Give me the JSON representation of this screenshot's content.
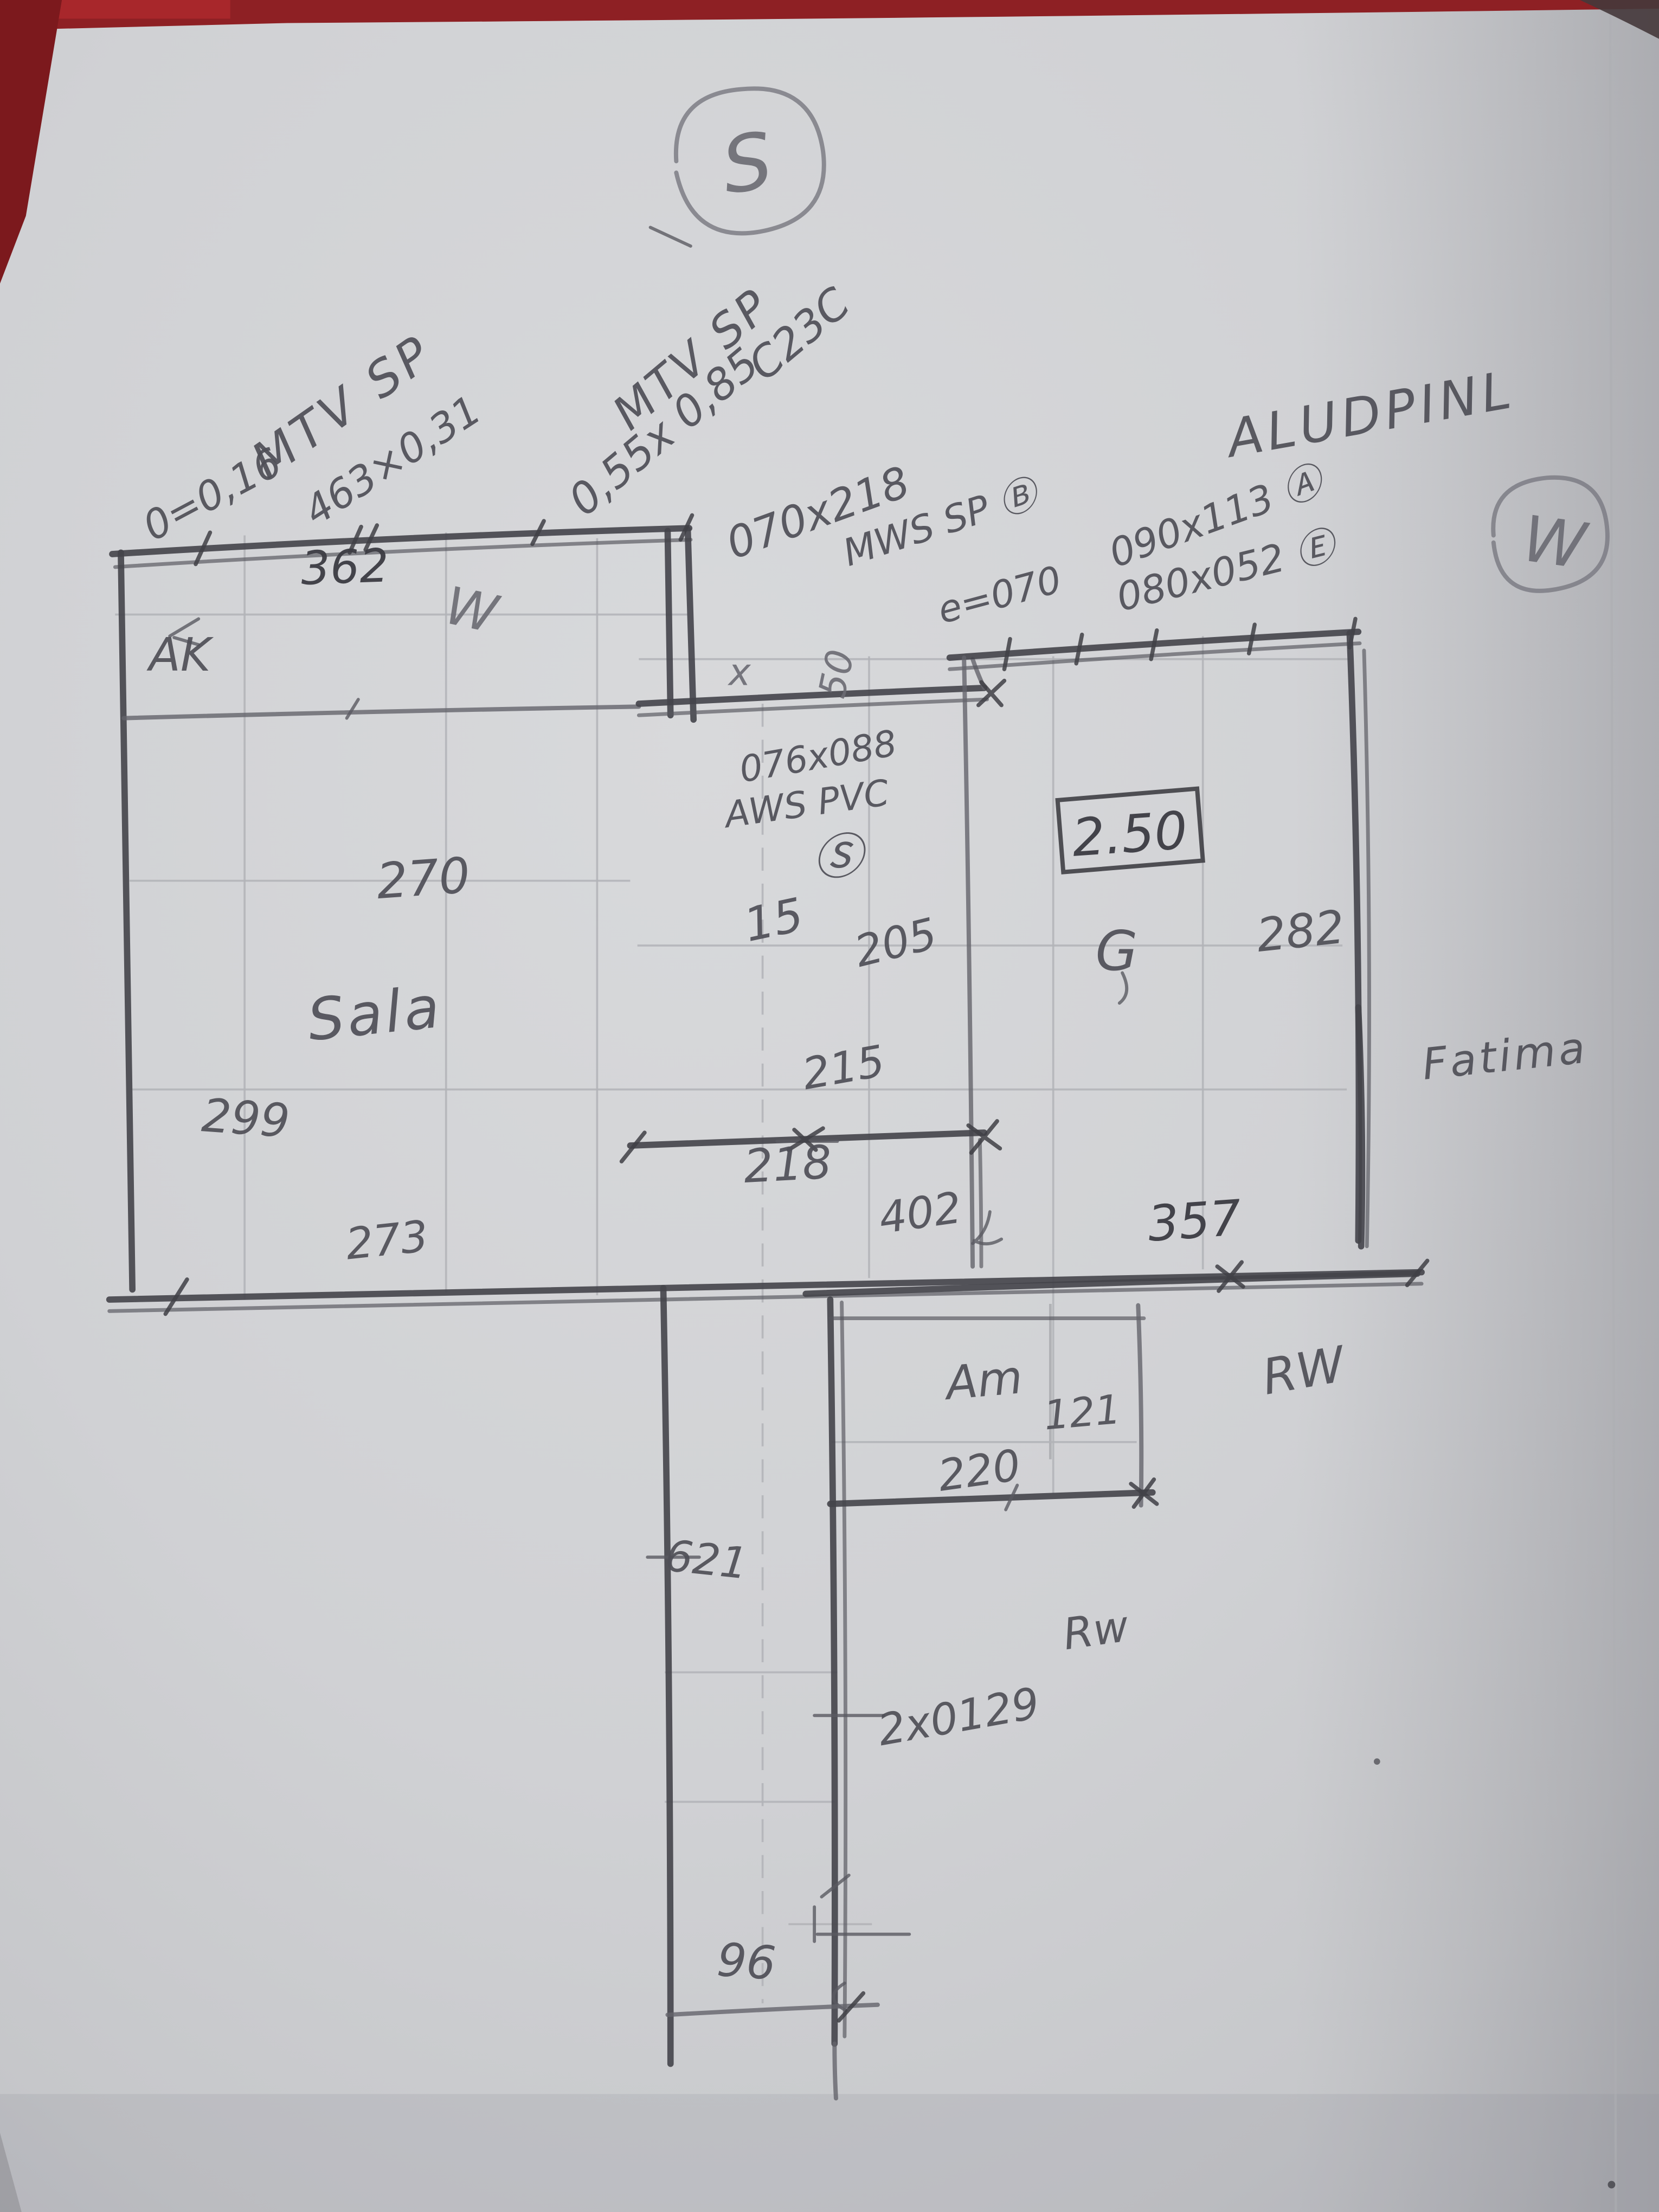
{
  "compass": {
    "south": "S",
    "west": "W"
  },
  "notes": {
    "left_window": {
      "l1": "MTV SP",
      "l2": "0=0,16",
      "l3": "463×0,31"
    },
    "mid_window": {
      "l1": "MTV SP",
      "l2": "0,55x 0,85",
      "l3": "C23C"
    },
    "door": {
      "l1": "070x218",
      "l2": "MWS SP Ⓑ"
    },
    "wall_thickness": "e=070",
    "right_material": {
      "l1": "ALUDPINL",
      "l2": "090x113 Ⓐ",
      "l3": "080x052 Ⓔ"
    },
    "small_window": {
      "l1": "076x088",
      "l2": "AWS PVC",
      "l3": "Ⓢ"
    },
    "name_right": "Fatima",
    "rw_upper": "RW",
    "rw_lower": "Rw",
    "corridor_note": "2x0129",
    "tick_x": "x",
    "tick_50": "50"
  },
  "rooms": {
    "sala": "Sala",
    "ak": "AK",
    "w_letter": "W",
    "g_letter": "G",
    "am": "Am"
  },
  "dims": {
    "top_width": "362",
    "sala_width": "270",
    "sala_height": "299",
    "sala_bottom": "273",
    "mid_small": "15",
    "mid_top": "205",
    "mid_height": "215",
    "mid_bottom": "218",
    "boxed_height": "2.50",
    "right_width": "282",
    "opening": "402",
    "right_bottom": "357",
    "am_height": "121",
    "am_width": "220",
    "corridor_height": "621",
    "bottom_width": "96"
  }
}
